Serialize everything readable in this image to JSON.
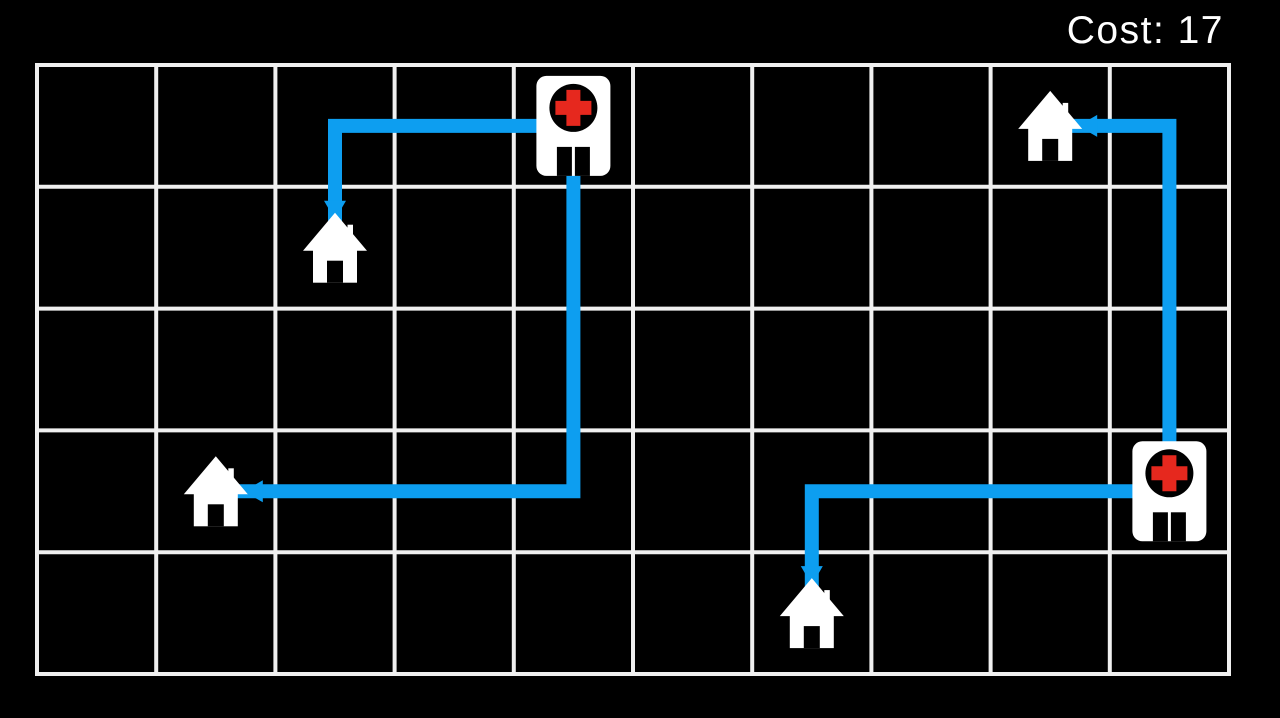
{
  "hud": {
    "cost_label": "Cost",
    "cost_value": 17,
    "cost_text": "Cost: 17"
  },
  "colors": {
    "background": "#000000",
    "grid_line": "#f0f0f0",
    "route": "#0d9ef0",
    "building_white": "#ffffff",
    "hospital_circle": "#000000",
    "hospital_cross": "#e6281e",
    "door_black": "#000000",
    "hud_text": "#ffffff"
  },
  "board": {
    "cols": 10,
    "rows": 5,
    "origin_x": 37,
    "origin_y": 65,
    "cell_width": 119.2,
    "cell_height": 121.8,
    "line_width": 4,
    "route_width": 14
  },
  "hospitals": [
    {
      "id": "hospital-1",
      "col": 4,
      "row": 0
    },
    {
      "id": "hospital-2",
      "col": 9,
      "row": 3
    }
  ],
  "houses": [
    {
      "id": "house-1",
      "col": 2,
      "row": 1
    },
    {
      "id": "house-2",
      "col": 1,
      "row": 3
    },
    {
      "id": "house-3",
      "col": 8,
      "row": 0
    },
    {
      "id": "house-4",
      "col": 6,
      "row": 4
    }
  ],
  "routes": [
    {
      "id": "route-house-1-to-hospital-1",
      "cells": [
        [
          2,
          1
        ],
        [
          2,
          0
        ],
        [
          4,
          0
        ]
      ]
    },
    {
      "id": "route-house-2-to-hospital-1",
      "cells": [
        [
          1,
          3
        ],
        [
          4,
          3
        ],
        [
          4,
          0
        ]
      ]
    },
    {
      "id": "route-house-3-to-hospital-2",
      "cells": [
        [
          8,
          0
        ],
        [
          9,
          0
        ],
        [
          9,
          3
        ]
      ]
    },
    {
      "id": "route-house-4-to-hospital-2",
      "cells": [
        [
          6,
          4
        ],
        [
          6,
          3
        ],
        [
          9,
          3
        ]
      ]
    }
  ]
}
